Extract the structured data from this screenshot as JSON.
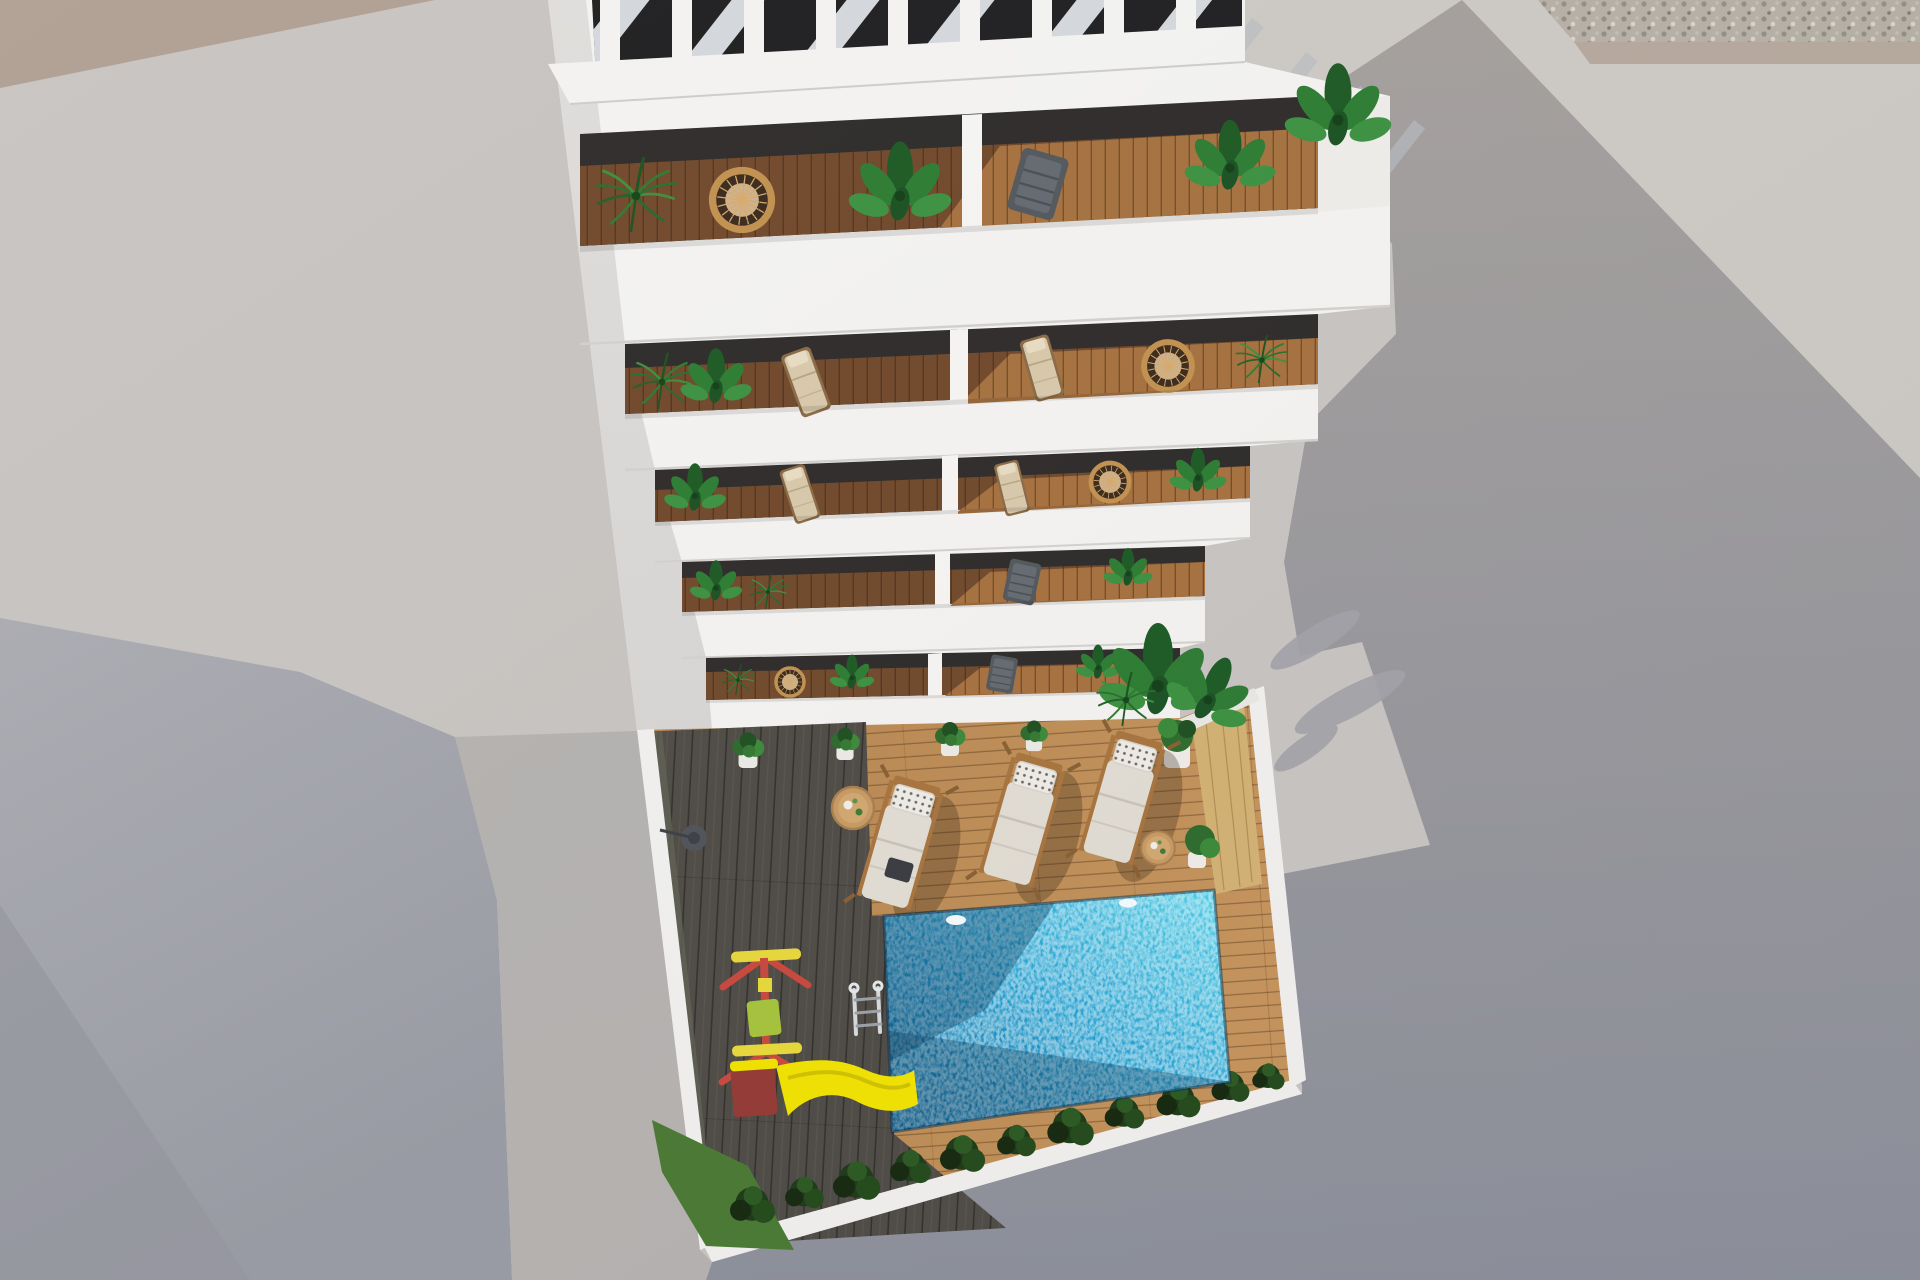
{
  "meta": {
    "kind": "architectural-3d-render",
    "view": "aerial top-down",
    "subject": "White residential building with five rows of tiered balconies above a private courtyard with swimming pool, sun loungers and a children's playground",
    "visible_text": "none"
  },
  "palette": {
    "concrete_base": "#c8c4c1",
    "concrete_sun_right": "#cdc9c4",
    "concrete_tan": "#b0a093",
    "gravel_base": "#b6b0a6",
    "shadow_warm": "#a5a09d",
    "shadow_cool": "#8d909b",
    "neighbor_top": "#abacb2",
    "neighbor_dark": "#999ba4",
    "concrete_mid": "#b5b2b0",
    "building_white": "#f4f3f1",
    "building_west": "#d8d6d4",
    "parapet_edge": "#d3d1ce",
    "pergola_dark": "#1f1e20",
    "interior_dark": "#2e2b2a",
    "balcony_wood": "#71492b",
    "balcony_wood_sun": "#a6713f",
    "deck_dark": "#4f4b45",
    "deck_light": "#b5854f",
    "deck_strip_sun": "#d3b173",
    "wall_white": "#f1f0ee",
    "pool_light": "#4fd0e9",
    "pool_mid": "#1f9fd2",
    "pool_deep": "#0b6ba0",
    "grass": "#4a7a33",
    "shrub_dark": "#1d3a17",
    "slide_yellow": "#f2e300",
    "slide_base_red": "#943a34",
    "swing_red": "#c8483c",
    "swing_yellow": "#e9d83b",
    "seat_lime": "#a6c33c",
    "lounger_cushion": "#e2ddd3",
    "lounger_pillow": "#efece6",
    "wood_frame": "#a8743e",
    "wicker": "#c2914f",
    "cushion_beige": "#d9c9ab",
    "chair_dark": "#53585d",
    "plant_dark": "#1d5a24",
    "plant_mid": "#2d7c33",
    "plant_light": "#3c9140",
    "table_wood": "#c89a63",
    "ladder_chrome": "#d7dbde"
  },
  "scene": {
    "surroundings": [
      "sunlit concrete plaza left",
      "tan paving strip top-left",
      "pebble gravel strip top-right",
      "long building shadow cast to the right",
      "shaded neighbouring lot lower-left"
    ],
    "building": {
      "roof": "white slatted pergola with diagonal sun stripes",
      "balcony_rows": 5,
      "units_per_row": 2,
      "balcony_items": [
        "palm plant",
        "banana plant",
        "rattan ring chair",
        "beige deck chair",
        "dark sling chair",
        "white divider wall"
      ]
    },
    "courtyard": {
      "decks": [
        "dark timber deck (shade)",
        "light timber deck (sun)",
        "pale plank strip at right"
      ],
      "pool": {
        "shape": "rectangle",
        "water": "sparkling turquoise",
        "glints": 2,
        "ladder": true
      },
      "sun_loungers": 3,
      "side_tables": 2,
      "potted_plants": 5,
      "playground": {
        "frame": "red and yellow swing",
        "seat": "lime green",
        "slide": "yellow with dark red base"
      },
      "landscaping": [
        "dark shrub row along boundary wall",
        "grass patch bottom-left",
        "corner planter with large plants"
      ],
      "extras": [
        "outdoor shower base disc"
      ]
    }
  }
}
